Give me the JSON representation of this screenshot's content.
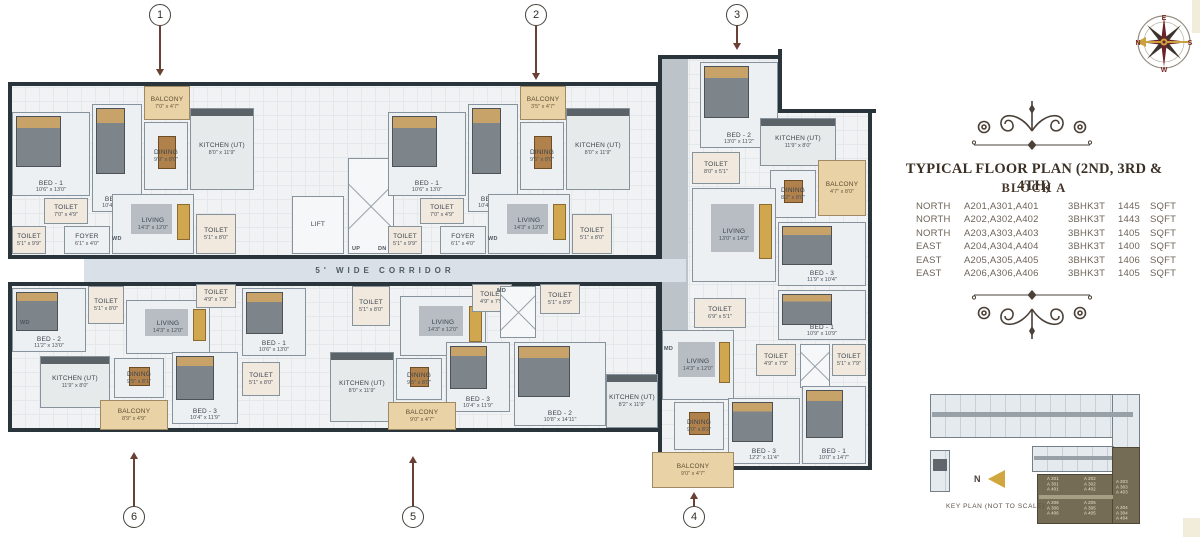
{
  "colors": {
    "wall": "#2a343b",
    "balcony_tan": "#e9d2a6",
    "accent_maroon": "#6d222a",
    "gold": "#c9a23f",
    "keyplan_highlight": "#746c55",
    "ink": "#3b3026",
    "callout": "#6b4034"
  },
  "title_block": {
    "title": "TYPICAL FLOOR PLAN (2ND, 3RD & 4TH)",
    "subtitle": "BLOCK A",
    "table": {
      "rows": [
        {
          "direction": "NORTH",
          "units": "A201,A301,A401",
          "type": "3BHK3T",
          "area": "1445",
          "unit": "SQFT"
        },
        {
          "direction": "NORTH",
          "units": "A202,A302,A402",
          "type": "3BHK3T",
          "area": "1443",
          "unit": "SQFT"
        },
        {
          "direction": "NORTH",
          "units": "A203,A303,A403",
          "type": "3BHK3T",
          "area": "1405",
          "unit": "SQFT"
        },
        {
          "direction": "EAST",
          "units": "A204,A304,A404",
          "type": "3BHK3T",
          "area": "1400",
          "unit": "SQFT"
        },
        {
          "direction": "EAST",
          "units": "A205,A305,A405",
          "type": "3BHK3T",
          "area": "1406",
          "unit": "SQFT"
        },
        {
          "direction": "EAST",
          "units": "A206,A306,A406",
          "type": "3BHK3T",
          "area": "1405",
          "unit": "SQFT"
        }
      ]
    }
  },
  "compass": {
    "top": "E",
    "left": "N",
    "right": "S",
    "bottom": "W"
  },
  "corridor": {
    "label": "5' WIDE CORRIDOR"
  },
  "floorplan": {
    "rooms": [
      {
        "label": "BALCONY",
        "dims": "7'0\" x 4'7\"",
        "x": 144,
        "y": 86,
        "w": 46,
        "h": 34,
        "type": "balcony"
      },
      {
        "label": "BED - 1",
        "dims": "10'6\" x 13'0\"",
        "x": 12,
        "y": 112,
        "w": 78,
        "h": 84,
        "type": "bed"
      },
      {
        "label": "BED - 3",
        "dims": "10'4\" x 11'9\"",
        "x": 92,
        "y": 104,
        "w": 50,
        "h": 108,
        "type": "bed"
      },
      {
        "label": "DINING",
        "dims": "9'9\" x 8'0\"",
        "x": 144,
        "y": 122,
        "w": 44,
        "h": 68,
        "type": "dining"
      },
      {
        "label": "KITCHEN (UT)",
        "dims": "8'0\" x 11'9\"",
        "x": 190,
        "y": 108,
        "w": 64,
        "h": 82,
        "type": "kitchen"
      },
      {
        "label": "TOILET",
        "dims": "7'0\" x 4'9\"",
        "x": 44,
        "y": 198,
        "w": 44,
        "h": 26,
        "type": "toilet"
      },
      {
        "label": "TOILET",
        "dims": "5'1\" x 9'9\"",
        "x": 12,
        "y": 226,
        "w": 34,
        "h": 28,
        "type": "toilet"
      },
      {
        "label": "FOYER",
        "dims": "6'1\" x 4'0\"",
        "x": 64,
        "y": 226,
        "w": 46,
        "h": 28,
        "type": "foyer"
      },
      {
        "label": "LIVING",
        "dims": "14'3\" x 12'0\"",
        "x": 112,
        "y": 194,
        "w": 82,
        "h": 60,
        "type": "living"
      },
      {
        "label": "TOILET",
        "dims": "5'1\" x 8'0\"",
        "x": 196,
        "y": 214,
        "w": 40,
        "h": 40,
        "type": "toilet"
      },
      {
        "label": "LIFT",
        "dims": "",
        "x": 292,
        "y": 196,
        "w": 52,
        "h": 58,
        "type": "lift"
      },
      {
        "label": "",
        "dims": "",
        "x": 348,
        "y": 158,
        "w": 46,
        "h": 96,
        "type": "stair"
      },
      {
        "label": "BALCONY",
        "dims": "3'5\" x 4'7\"",
        "x": 520,
        "y": 86,
        "w": 46,
        "h": 34,
        "type": "balcony"
      },
      {
        "label": "BED - 1",
        "dims": "10'6\" x 13'0\"",
        "x": 388,
        "y": 112,
        "w": 78,
        "h": 84,
        "type": "bed"
      },
      {
        "label": "BED - 3",
        "dims": "10'4\" x 11'9\"",
        "x": 468,
        "y": 104,
        "w": 50,
        "h": 108,
        "type": "bed"
      },
      {
        "label": "DINING",
        "dims": "9'5\" x 8'0\"",
        "x": 520,
        "y": 122,
        "w": 44,
        "h": 68,
        "type": "dining"
      },
      {
        "label": "KITCHEN (UT)",
        "dims": "8'0\" x 11'9\"",
        "x": 566,
        "y": 108,
        "w": 64,
        "h": 82,
        "type": "kitchen"
      },
      {
        "label": "TOILET",
        "dims": "7'0\" x 4'9\"",
        "x": 420,
        "y": 198,
        "w": 44,
        "h": 26,
        "type": "toilet"
      },
      {
        "label": "TOILET",
        "dims": "5'1\" x 9'9\"",
        "x": 388,
        "y": 226,
        "w": 34,
        "h": 28,
        "type": "toilet"
      },
      {
        "label": "FOYER",
        "dims": "6'1\" x 4'0\"",
        "x": 440,
        "y": 226,
        "w": 46,
        "h": 28,
        "type": "foyer"
      },
      {
        "label": "LIVING",
        "dims": "14'3\" x 12'0\"",
        "x": 488,
        "y": 194,
        "w": 82,
        "h": 60,
        "type": "living"
      },
      {
        "label": "TOILET",
        "dims": "5'1\" x 8'0\"",
        "x": 572,
        "y": 214,
        "w": 40,
        "h": 40,
        "type": "toilet"
      },
      {
        "label": "BED - 2",
        "dims": "13'0\" x 11'2\"",
        "x": 700,
        "y": 62,
        "w": 78,
        "h": 86,
        "type": "bed"
      },
      {
        "label": "TOILET",
        "dims": "8'0\" x 5'1\"",
        "x": 692,
        "y": 152,
        "w": 48,
        "h": 32,
        "type": "toilet"
      },
      {
        "label": "KITCHEN (UT)",
        "dims": "11'9\" x 8'0\"",
        "x": 760,
        "y": 118,
        "w": 76,
        "h": 48,
        "type": "kitchen"
      },
      {
        "label": "DINING",
        "dims": "8'2\" x 8'0\"",
        "x": 770,
        "y": 170,
        "w": 46,
        "h": 48,
        "type": "dining"
      },
      {
        "label": "BALCONY",
        "dims": "4'7\" x 8'0\"",
        "x": 818,
        "y": 160,
        "w": 48,
        "h": 56,
        "type": "balcony"
      },
      {
        "label": "LIVING",
        "dims": "13'0\" x 14'3\"",
        "x": 692,
        "y": 188,
        "w": 84,
        "h": 94,
        "type": "living"
      },
      {
        "label": "BED - 3",
        "dims": "11'9\" x 10'4\"",
        "x": 778,
        "y": 222,
        "w": 88,
        "h": 64,
        "type": "bed"
      },
      {
        "label": "BED - 1",
        "dims": "10'9\" x 10'9\"",
        "x": 778,
        "y": 290,
        "w": 88,
        "h": 50,
        "type": "bed"
      },
      {
        "label": "TOILET",
        "dims": "4'9\" x 7'9\"",
        "x": 756,
        "y": 344,
        "w": 40,
        "h": 32,
        "type": "toilet"
      },
      {
        "label": "",
        "dims": "",
        "x": 800,
        "y": 344,
        "w": 30,
        "h": 44,
        "type": "stair"
      },
      {
        "label": "TOILET",
        "dims": "5'1\" x 7'9\"",
        "x": 832,
        "y": 344,
        "w": 34,
        "h": 32,
        "type": "toilet"
      },
      {
        "label": "TOILET",
        "dims": "6'9\" x 5'1\"",
        "x": 694,
        "y": 298,
        "w": 52,
        "h": 30,
        "type": "toilet"
      },
      {
        "label": "LIVING",
        "dims": "14'3\" x 12'0\"",
        "x": 662,
        "y": 330,
        "w": 72,
        "h": 70,
        "type": "living"
      },
      {
        "label": "KITCHEN (UT)",
        "dims": "8'2\" x 11'9\"",
        "x": 606,
        "y": 374,
        "w": 52,
        "h": 54,
        "type": "kitchen"
      },
      {
        "label": "DINING",
        "dims": "9'0\" x 8'2\"",
        "x": 674,
        "y": 402,
        "w": 50,
        "h": 48,
        "type": "dining"
      },
      {
        "label": "BALCONY",
        "dims": "9'0\" x 4'7\"",
        "x": 652,
        "y": 452,
        "w": 82,
        "h": 36,
        "type": "balcony"
      },
      {
        "label": "BED - 3",
        "dims": "12'2\" x 11'4\"",
        "x": 728,
        "y": 398,
        "w": 72,
        "h": 66,
        "type": "bed"
      },
      {
        "label": "BED - 1",
        "dims": "10'0\" x 14'7\"",
        "x": 802,
        "y": 386,
        "w": 64,
        "h": 78,
        "type": "bed"
      },
      {
        "label": "TOILET",
        "dims": "5'1\" x 8'0\"",
        "x": 352,
        "y": 286,
        "w": 38,
        "h": 40,
        "type": "toilet"
      },
      {
        "label": "LIVING",
        "dims": "14'3\" x 12'0\"",
        "x": 400,
        "y": 296,
        "w": 86,
        "h": 60,
        "type": "living"
      },
      {
        "label": "TOILET",
        "dims": "4'9\" x 7'9\"",
        "x": 472,
        "y": 284,
        "w": 40,
        "h": 28,
        "type": "toilet"
      },
      {
        "label": "",
        "dims": "",
        "x": 500,
        "y": 286,
        "w": 36,
        "h": 52,
        "type": "stair"
      },
      {
        "label": "TOILET",
        "dims": "5'1\" x 8'9\"",
        "x": 540,
        "y": 284,
        "w": 40,
        "h": 30,
        "type": "toilet"
      },
      {
        "label": "KITCHEN (UT)",
        "dims": "8'0\" x 11'9\"",
        "x": 330,
        "y": 352,
        "w": 64,
        "h": 70,
        "type": "kitchen"
      },
      {
        "label": "DINING",
        "dims": "9'5\" x 8'0\"",
        "x": 396,
        "y": 358,
        "w": 46,
        "h": 42,
        "type": "dining"
      },
      {
        "label": "BALCONY",
        "dims": "9'0\" x 4'7\"",
        "x": 388,
        "y": 402,
        "w": 68,
        "h": 28,
        "type": "balcony"
      },
      {
        "label": "BED - 3",
        "dims": "10'4\" x 11'9\"",
        "x": 446,
        "y": 342,
        "w": 64,
        "h": 70,
        "type": "bed"
      },
      {
        "label": "BED - 2",
        "dims": "10'8\" x 14'11\"",
        "x": 514,
        "y": 342,
        "w": 92,
        "h": 84,
        "type": "bed"
      },
      {
        "label": "BED - 2",
        "dims": "11'2\" x 13'0\"",
        "x": 12,
        "y": 288,
        "w": 74,
        "h": 64,
        "type": "bed"
      },
      {
        "label": "TOILET",
        "dims": "5'1\" x 8'0\"",
        "x": 88,
        "y": 286,
        "w": 36,
        "h": 38,
        "type": "toilet"
      },
      {
        "label": "LIVING",
        "dims": "14'3\" x 12'0\"",
        "x": 126,
        "y": 300,
        "w": 84,
        "h": 54,
        "type": "living"
      },
      {
        "label": "TOILET",
        "dims": "4'9\" x 7'9\"",
        "x": 196,
        "y": 284,
        "w": 40,
        "h": 24,
        "type": "toilet"
      },
      {
        "label": "KITCHEN (UT)",
        "dims": "11'9\" x 8'0\"",
        "x": 40,
        "y": 356,
        "w": 70,
        "h": 52,
        "type": "kitchen"
      },
      {
        "label": "DINING",
        "dims": "9'5\" x 8'1\"",
        "x": 114,
        "y": 358,
        "w": 50,
        "h": 40,
        "type": "dining"
      },
      {
        "label": "BALCONY",
        "dims": "8'9\" x 4'9\"",
        "x": 100,
        "y": 400,
        "w": 68,
        "h": 30,
        "type": "balcony"
      },
      {
        "label": "BED - 3",
        "dims": "10'4\" x 11'9\"",
        "x": 172,
        "y": 352,
        "w": 66,
        "h": 72,
        "type": "bed"
      },
      {
        "label": "BED - 1",
        "dims": "10'6\" x 13'0\"",
        "x": 242,
        "y": 288,
        "w": 64,
        "h": 68,
        "type": "bed"
      },
      {
        "label": "TOILET",
        "dims": "5'1\" x 8'0\"",
        "x": 242,
        "y": 362,
        "w": 38,
        "h": 34,
        "type": "toilet"
      }
    ],
    "marks": [
      {
        "t": "UP",
        "x": 352,
        "y": 246
      },
      {
        "t": "DN",
        "x": 378,
        "y": 246
      },
      {
        "t": "WD",
        "x": 112,
        "y": 236
      },
      {
        "t": "WD",
        "x": 488,
        "y": 236
      },
      {
        "t": "MD",
        "x": 664,
        "y": 346
      },
      {
        "t": "MD",
        "x": 497,
        "y": 288
      },
      {
        "t": "WD",
        "x": 20,
        "y": 320
      }
    ],
    "markers": [
      {
        "n": "1",
        "x": 160,
        "side": "top",
        "tip": 76
      },
      {
        "n": "2",
        "x": 536,
        "side": "top",
        "tip": 80
      },
      {
        "n": "3",
        "x": 737,
        "side": "top",
        "tip": 50
      },
      {
        "n": "4",
        "x": 694,
        "side": "bottom",
        "tip": 492
      },
      {
        "n": "5",
        "x": 413,
        "side": "bottom",
        "tip": 456
      },
      {
        "n": "6",
        "x": 134,
        "side": "bottom",
        "tip": 452
      }
    ]
  },
  "keyplan": {
    "caption": "KEY PLAN (NOT TO SCALE)",
    "north_label": "N",
    "units": [
      {
        "lines": "A 201\nA 301\nA 401",
        "x": 1047,
        "y": 477
      },
      {
        "lines": "A 202\nA 302\nA 402",
        "x": 1084,
        "y": 477
      },
      {
        "lines": "A 203\nA 303\nA 403",
        "x": 1116,
        "y": 480
      },
      {
        "lines": "A 206\nA 306\nA 406",
        "x": 1047,
        "y": 501
      },
      {
        "lines": "A 205\nA 305\nA 405",
        "x": 1084,
        "y": 501
      },
      {
        "lines": "A 204\nA 304\nA 404",
        "x": 1116,
        "y": 506
      }
    ]
  }
}
